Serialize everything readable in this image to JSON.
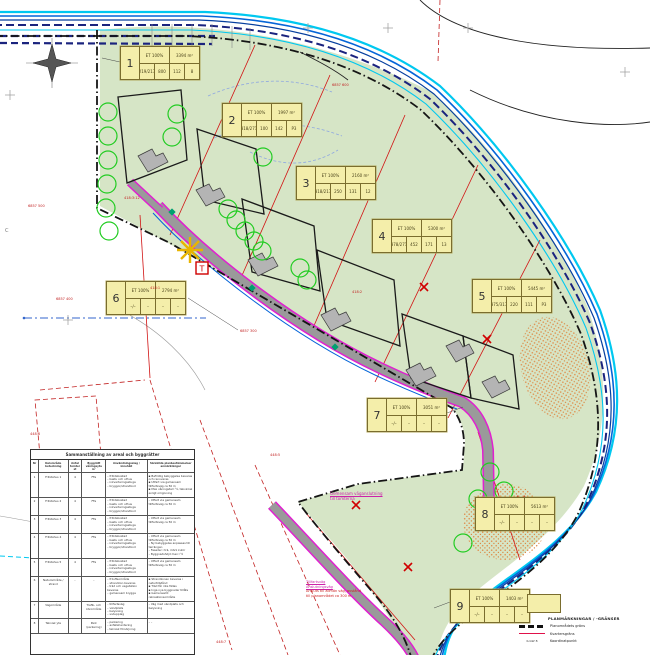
{
  "parcels": [
    {
      "no": "1",
      "eff": "ET 100%",
      "area": "3394 m²",
      "c1": "219/217",
      "c2": "800",
      "c3": "112",
      "c4": "8",
      "x": 120,
      "y": 46
    },
    {
      "no": "2",
      "eff": "ET 100%",
      "area": "1997 m²",
      "c1": "318/271",
      "c2": "100",
      "c3": "142",
      "c4": "P3",
      "x": 222,
      "y": 103
    },
    {
      "no": "3",
      "eff": "ET 100%",
      "area": "2160 m²",
      "c1": "318/217",
      "c2": "250",
      "c3": "131",
      "c4": "12",
      "x": 296,
      "y": 166
    },
    {
      "no": "4",
      "eff": "ET 100%",
      "area": "5300 m²",
      "c1": "378/271",
      "c2": "452",
      "c3": "171",
      "c4": "13",
      "x": 372,
      "y": 219
    },
    {
      "no": "5",
      "eff": "ET 100%",
      "area": "5445 m²",
      "c1": "375/317",
      "c2": "220",
      "c3": "111",
      "c4": "P3",
      "x": 472,
      "y": 279
    },
    {
      "no": "6",
      "eff": "ET 100%",
      "area": "2794 m²",
      "c1": "–/–",
      "c2": "–",
      "c3": "–",
      "c4": "–",
      "x": 106,
      "y": 281
    },
    {
      "no": "7",
      "eff": "ET 100%",
      "area": "3051 m²",
      "c1": "–/–",
      "c2": "–",
      "c3": "–",
      "c4": "–",
      "x": 367,
      "y": 398
    },
    {
      "no": "8",
      "eff": "ET 100%",
      "area": "5613 m²",
      "c1": "–/–",
      "c2": "–",
      "c3": "–",
      "c4": "–",
      "x": 475,
      "y": 497
    },
    {
      "no": "9",
      "eff": "ET 100%",
      "area": "1403 m²",
      "c1": "–/–",
      "c2": "–",
      "c3": "–",
      "c4": "–",
      "x": 450,
      "y": 589
    }
  ],
  "table": {
    "title": "Sammanställning av areal och byggrätter",
    "headers": [
      "Nr",
      "Delområde beteckning",
      "Antal tomter st",
      "Byggrätt våningsyta m²",
      "Användningsslag / innehåll",
      "Särskilda planbestämmelser anmärkningar"
    ],
    "rows": [
      {
        "nr": "1",
        "name": "Fritidshus 1",
        "qty": "4",
        "code": "FFa",
        "sq": true,
        "use": [
          "fritidsbostad",
          "bastu och uthus",
          "inkvarteringsstuga",
          "bryggor/strandbod"
        ],
        "notes": [
          "Befintlig bebyggelse bevaras och renoveras",
          "Utfart via gemensam tillfartsväg ca 50 m",
          "Max våningstal I ½, takvinkel enligt omgivning"
        ]
      },
      {
        "nr": "2",
        "name": "Fritidshus 2",
        "qty": "4",
        "code": "FFa",
        "sq": false,
        "use": [
          "fritidsbostad",
          "bastu och uthus",
          "inkvarteringsstuga",
          "bryggor/strandbod"
        ],
        "notes": [
          "Utfart via gemensam tillfartsväg ca 50 m"
        ]
      },
      {
        "nr": "3",
        "name": "Fritidshus 3",
        "qty": "4",
        "code": "FFa",
        "sq": false,
        "use": [
          "fritidsbostad",
          "bastu och uthus",
          "inkvarteringsstuga",
          "bryggor/strandbod"
        ],
        "notes": [
          "Utfart via gemensam tillfartsväg ca 50 m"
        ]
      },
      {
        "nr": "4",
        "name": "Fritidshus 4",
        "qty": "4",
        "code": "FFa",
        "sq": false,
        "use": [
          "fritidsbostad",
          "bastu och uthus",
          "inkvarteringsstuga",
          "bryggor/strandbod"
        ],
        "notes": [
          "Utfart via gemensam tillfartsväg ca 50 m",
          "Ny bebyggelse anpassas till terrängen",
          "Fasader i trä, mörk kulör",
          "Byggnadshöjd max I ½"
        ]
      },
      {
        "nr": "5",
        "name": "Fritidshus 5",
        "qty": "4",
        "code": "FFa",
        "sq": false,
        "use": [
          "fritidsbostad",
          "bastu och uthus",
          "inkvarteringsstuga",
          "bryggor/strandbod"
        ],
        "notes": [
          "Utfart via gemensam tillfartsväg ca 50 m"
        ]
      },
      {
        "nr": "6",
        "name": "Naturområde / strand",
        "qty": "–",
        "code": "–",
        "sq": true,
        "use": [
          "friluftsområde",
          "strandzon bevaras",
          "träd och vegetation bevaras",
          "gemensam brygga"
        ],
        "notes": [
          "Strandzonen bevaras i naturtillstånd",
          "Träd får inte fällas",
          "Inga nya byggnader tillåts",
          "Gemensamt rekreationsområde"
        ]
      },
      {
        "nr": "7",
        "name": "Vägområde",
        "qty": "",
        "code": "Trafik- och körområde",
        "sq": false,
        "use": [
          "tillfartsväg",
          "vändplats",
          "belysning",
          "snöupplag"
        ],
        "notes": [
          "Väg med vändplats och belysning"
        ]
      },
      {
        "nr": "8",
        "name": "Teknisk yta",
        "qty": "",
        "code": "Park (parkering)",
        "sq": false,
        "use": [
          "parkering",
          "avfallshantering",
          "teknisk försörjning"
        ],
        "notes": [
          "–"
        ]
      }
    ]
  },
  "legend": {
    "title": "PLANMÄRKNINGAR / -GRÄNSER",
    "items": [
      {
        "symbol": "plan-boundary-dash",
        "key": "",
        "label": "Planområdets gräns"
      },
      {
        "symbol": "red-line",
        "key": "",
        "label": "Kvartersgräns"
      },
      {
        "symbol": "text-key",
        "key": "K-GW  8",
        "label": "Koordinatpunkt"
      }
    ]
  },
  "annotations": {
    "mid": {
      "lines": [
        "Gemensam väganslutning",
        "till tomterna"
      ]
    },
    "bottom": {
      "lines": [
        "Tillfartsväg",
        "Anslutningsväg",
        "Ansluts till allmän väg, avstånd",
        "till planområdet ca 300 m"
      ]
    }
  },
  "map_labels": {
    "t_marker": "T",
    "c_label": "C",
    "red_labels": [
      {
        "x": 28,
        "y": 204,
        "t": "6857 500"
      },
      {
        "x": 124,
        "y": 196,
        "t": "418:3:12"
      },
      {
        "x": 56,
        "y": 297,
        "t": "6857 400"
      },
      {
        "x": 150,
        "y": 286,
        "t": "418:1"
      },
      {
        "x": 240,
        "y": 329,
        "t": "6857 300"
      },
      {
        "x": 332,
        "y": 83,
        "t": "6857 600"
      },
      {
        "x": 270,
        "y": 453,
        "t": "448:5"
      },
      {
        "x": 216,
        "y": 640,
        "t": "448:7"
      },
      {
        "x": 30,
        "y": 432,
        "t": "448:6"
      },
      {
        "x": 352,
        "y": 290,
        "t": "418:2"
      }
    ]
  },
  "map_symbols": {
    "trees": [
      [
        108,
        112
      ],
      [
        108,
        136
      ],
      [
        108,
        160
      ],
      [
        107,
        184
      ],
      [
        106,
        208
      ],
      [
        109,
        231
      ],
      [
        177,
        114
      ],
      [
        172,
        137
      ],
      [
        263,
        157
      ],
      [
        228,
        209
      ],
      [
        236,
        220
      ],
      [
        245,
        231
      ],
      [
        254,
        241
      ],
      [
        262,
        251
      ],
      [
        300,
        268
      ],
      [
        307,
        280
      ],
      [
        490,
        472
      ],
      [
        504,
        491
      ],
      [
        517,
        511
      ],
      [
        478,
        499
      ],
      [
        463,
        543
      ]
    ],
    "x_marks": [
      [
        424,
        287
      ],
      [
        487,
        339
      ],
      [
        356,
        505
      ],
      [
        521,
        500
      ],
      [
        408,
        567
      ]
    ],
    "diamonds": [
      [
        172,
        212
      ],
      [
        252,
        288
      ],
      [
        335,
        347
      ]
    ],
    "grid_crosses": [
      [
        308,
        28
      ],
      [
        388,
        28
      ],
      [
        468,
        28
      ],
      [
        625,
        72
      ],
      [
        68,
        320
      ],
      [
        10,
        95
      ]
    ]
  },
  "colors": {
    "green_area": "#d6e5c6",
    "water_cyan": "#00c8f0",
    "water_blue": "#0565d8",
    "water_navy": "#1a237e",
    "road_grey": "#9a9a9a",
    "magenta": "#e020d0",
    "parcel_red": "#d11414",
    "box_yellow": "#f4eeaa",
    "tree_green": "#22cc22",
    "stipple_orange": "#e09050",
    "boundary_black": "#151515"
  }
}
